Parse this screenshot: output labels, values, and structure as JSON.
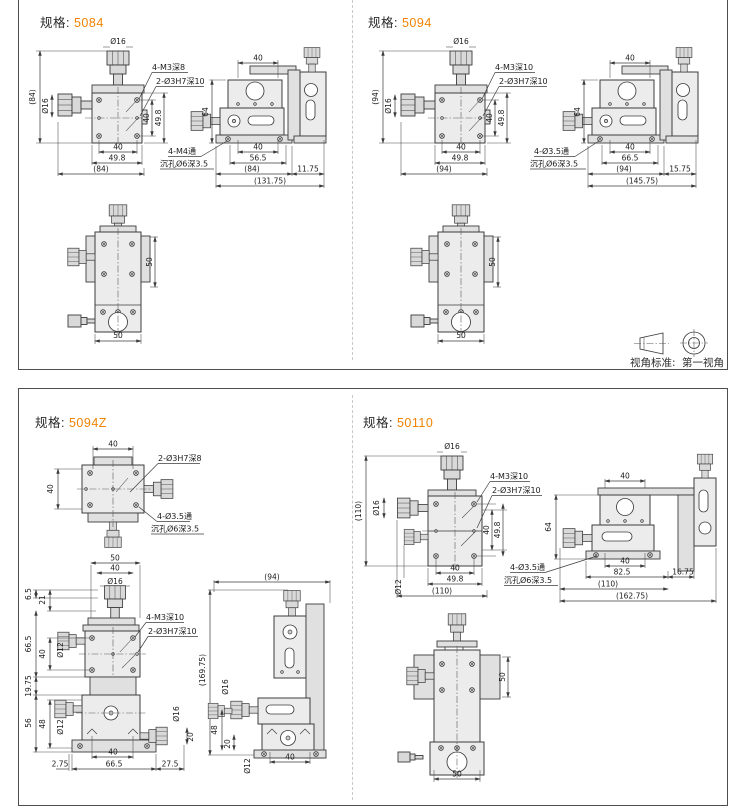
{
  "page": {
    "spec_label": "规格:",
    "view_note_label": "视角标准:",
    "view_note_value": "第一视角"
  },
  "p5084": {
    "spec": "5084",
    "front": {
      "phi16": "Ø16",
      "total_h": "(84)",
      "knob_phi16": "Ø16",
      "callout_m3": "4-M3深8",
      "callout_h7": "2-Ø3H7深10",
      "right_40": "40",
      "right_498": "49.8",
      "bot_40": "40",
      "bot_498": "49.8",
      "bot_total": "(84)"
    },
    "side": {
      "top_40": "40",
      "h_64": "64",
      "callout1": "4-M4通",
      "callout2": "沉孔Ø6深3.5",
      "bot_40": "40",
      "bot_mid": "56.5",
      "bot_paren": "(84)",
      "bot_off": "11.75",
      "bot_total": "(131.75)"
    },
    "bottom": {
      "r_50": "50",
      "b_50": "50"
    }
  },
  "p5094": {
    "spec": "5094",
    "front": {
      "phi16": "Ø16",
      "total_h": "(94)",
      "knob_phi16": "Ø16",
      "callout_m3": "4-M3深10",
      "callout_h7": "2-Ø3H7深10",
      "right_40": "40",
      "right_498": "49.8",
      "bot_40": "40",
      "bot_498": "49.8",
      "bot_total": "(94)"
    },
    "side": {
      "top_40": "40",
      "h_64": "64",
      "callout1": "4-Ø3.5通",
      "callout2": "沉孔Ø6深3.5",
      "bot_40": "40",
      "bot_mid": "66.5",
      "bot_paren": "(94)",
      "bot_off": "15.75",
      "bot_total": "(145.75)"
    },
    "bottom": {
      "r_50": "50",
      "b_50": "50"
    }
  },
  "p5094z": {
    "spec": "5094Z",
    "top": {
      "t_40": "40",
      "l_40": "40",
      "callout_h7": "2-Ø3H7深8",
      "callout1": "4-Ø3.5通",
      "callout2": "沉孔Ø6深3.5"
    },
    "front": {
      "t_50": "50",
      "t_40": "40",
      "phi16": "Ø16",
      "d_65": "6.5",
      "d_21": "21",
      "d_665": "66.5",
      "d_40": "40",
      "d_phi12a": "Ø12",
      "d_1975": "19.75",
      "d_56": "56",
      "d_48": "48",
      "d_phi12b": "Ø12",
      "callout_m3": "4-M3深10",
      "callout_h7": "2-Ø3H7深10",
      "r_phi16": "Ø16",
      "r_20": "20",
      "b_40": "40",
      "b_275": "2.75",
      "b_665": "66.5",
      "b_275r": "27.5"
    },
    "side": {
      "t_94": "(94)",
      "h_total": "(169.75)",
      "phi16": "Ø16",
      "d_48": "48",
      "d_20": "20",
      "phi12": "Ø12",
      "b_40": "40"
    }
  },
  "p50110": {
    "spec": "50110",
    "front": {
      "phi16": "Ø16",
      "total_h": "(110)",
      "knob_phi16": "Ø16",
      "knob_phi12": "Ø12",
      "callout_m3": "4-M3深10",
      "callout_h7": "2-Ø3H7深10",
      "right_40": "40",
      "right_498": "49.8",
      "bot_40": "40",
      "bot_498": "49.8",
      "bot_total": "(110)"
    },
    "side": {
      "top_40": "40",
      "h_64": "64",
      "callout1": "4-Ø3.5通",
      "callout2": "沉孔Ø6深3.5",
      "bot_40": "40",
      "bot_825": "82.5",
      "bot_110": "(110)",
      "bot_off": "16.75",
      "bot_total": "(162.75)"
    },
    "bottom": {
      "r_50": "50",
      "b_50": "50"
    }
  },
  "colors": {
    "accent": "#f08300",
    "line": "#3c3c3c",
    "border": "#4e4e4e"
  }
}
